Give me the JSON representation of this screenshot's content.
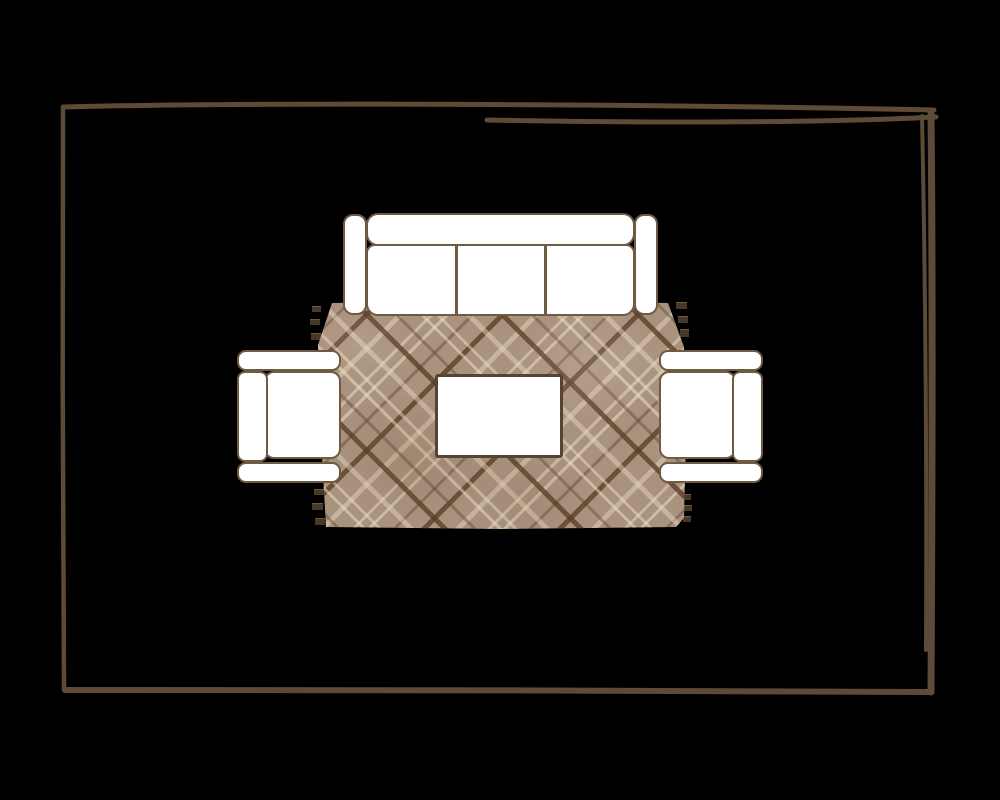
{
  "scene": {
    "description": "Top-down living room furniture layout plan on a black background",
    "room_outline_style": "hand-drawn sketch rectangle"
  },
  "colors": {
    "background": "#000000",
    "room_border": "#5d4a37",
    "furniture_outline": "#6f5a44",
    "furniture_fill": "#ffffff",
    "table_border": "#564433",
    "rug_base": "#a9927e",
    "rug_stripe_light": "#d8c9ae",
    "rug_stripe_dark": "#6b4f38",
    "rug_fringe": "#473828"
  },
  "furniture": {
    "sofa": {
      "label": "three-seat sofa",
      "seat_count": 3
    },
    "armchair_left": {
      "label": "armchair facing right"
    },
    "armchair_right": {
      "label": "armchair facing left"
    },
    "coffee_table": {
      "label": "coffee table"
    },
    "rug": {
      "label": "plaid area rug",
      "pattern": "diagonal plaid with fringe",
      "fringe_tufts": 12
    }
  }
}
